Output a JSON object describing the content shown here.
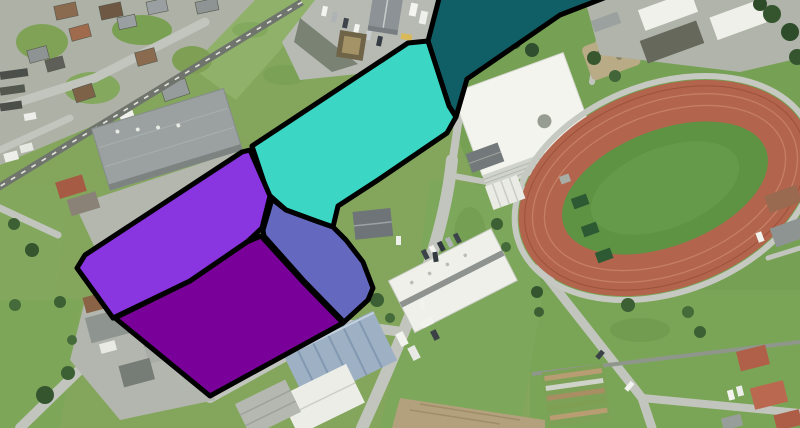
{
  "map": {
    "view": "aerial-imagery",
    "overlay_outline_color": "#000000",
    "overlay_outline_width": 5,
    "overlay_polygons": [
      {
        "id": "zone-dark-teal",
        "color": "#115F66",
        "points": "441,-9 622,-9 560,15 467,79 456,117 449,106 428,41"
      },
      {
        "id": "zone-turquoise",
        "color": "#3BD6C4",
        "points": "252,146 408,43 428,41 449,106 456,117 447,133 378,180 338,206 333,227 316,221 286,210 268,194"
      },
      {
        "id": "zone-purple",
        "color": "#8A36E0",
        "points": "242,152 85,255 77,268 113,318 190,281 247,242 262,228 270,196 250,150"
      },
      {
        "id": "zone-slate-blue",
        "color": "#6568BF",
        "points": "272,199 286,210 316,221 333,227 346,240 363,262 373,288 368,300 344,322 304,281 264,236 263,230"
      },
      {
        "id": "zone-dark-purple",
        "color": "#790199",
        "points": "115,318 190,281 247,242 261,236 303,282 343,323 210,396"
      }
    ],
    "basemap_palette": {
      "grass": "#83A65C",
      "road": "#C2C5BE",
      "track_red": "#B2644C",
      "roof_white": "#F3F4EE",
      "roof_red": "#B05F49"
    }
  }
}
